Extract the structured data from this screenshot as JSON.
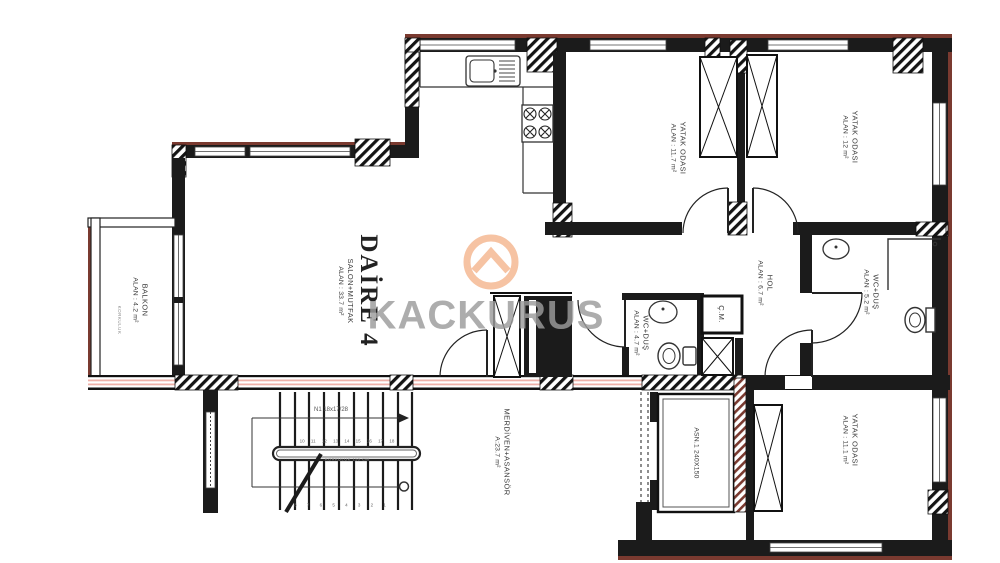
{
  "brand": {
    "watermark_text": "KACKURUS",
    "logo_icon": "chevron-circle-icon"
  },
  "unit": {
    "title": "DAİRE 4",
    "subtitle": "SALON+MUTFAK",
    "area": "ALAN : 33.7 m²"
  },
  "rooms": {
    "balcony": {
      "name": "BALKON",
      "area": "ALAN : 4.2 m²"
    },
    "bedroom_top_1": {
      "name": "YATAK ODASI",
      "area": "ALAN : 11.7 m²"
    },
    "bedroom_top_2": {
      "name": "YATAK ODASI",
      "area": "ALAN : 12 m²"
    },
    "hall": {
      "name": "HOL",
      "area": "ALAN : 6.7 m²"
    },
    "bathroom_main": {
      "name": "WC+DUŞ",
      "area": "ALAN : 5.2 m²"
    },
    "bathroom_small": {
      "name": "WC+DUŞ",
      "area": "ALAN : 4.7 m²"
    },
    "laundry_closet": {
      "name": "Ç.M."
    },
    "stairwell": {
      "name": "MERDİVEN+ASANSÖR",
      "area": "A:23.7 m²"
    },
    "elevator": {
      "name": "ASN.1 240X150"
    },
    "bedroom_bottom": {
      "name": "YATAK ODASI",
      "area": "ALAN : 11.1 m²"
    }
  },
  "stairs": {
    "flight_note": "N1 18x17/28",
    "upper_step_numbers": "10 11 12 13 14 15 16 17 18",
    "lower_step_numbers": "8 7 6 5 4 3 2 1",
    "rail_note": "KORKULUK 110 CM"
  },
  "balcony_note": "KORKULUK",
  "colors": {
    "wall": "#1b1b1b",
    "accent_maroon": "#7a3a30",
    "accent_pink": "#eeb0a8",
    "watermark_peach": "#f6c3a3",
    "watermark_gray": "#9c9c9c"
  }
}
